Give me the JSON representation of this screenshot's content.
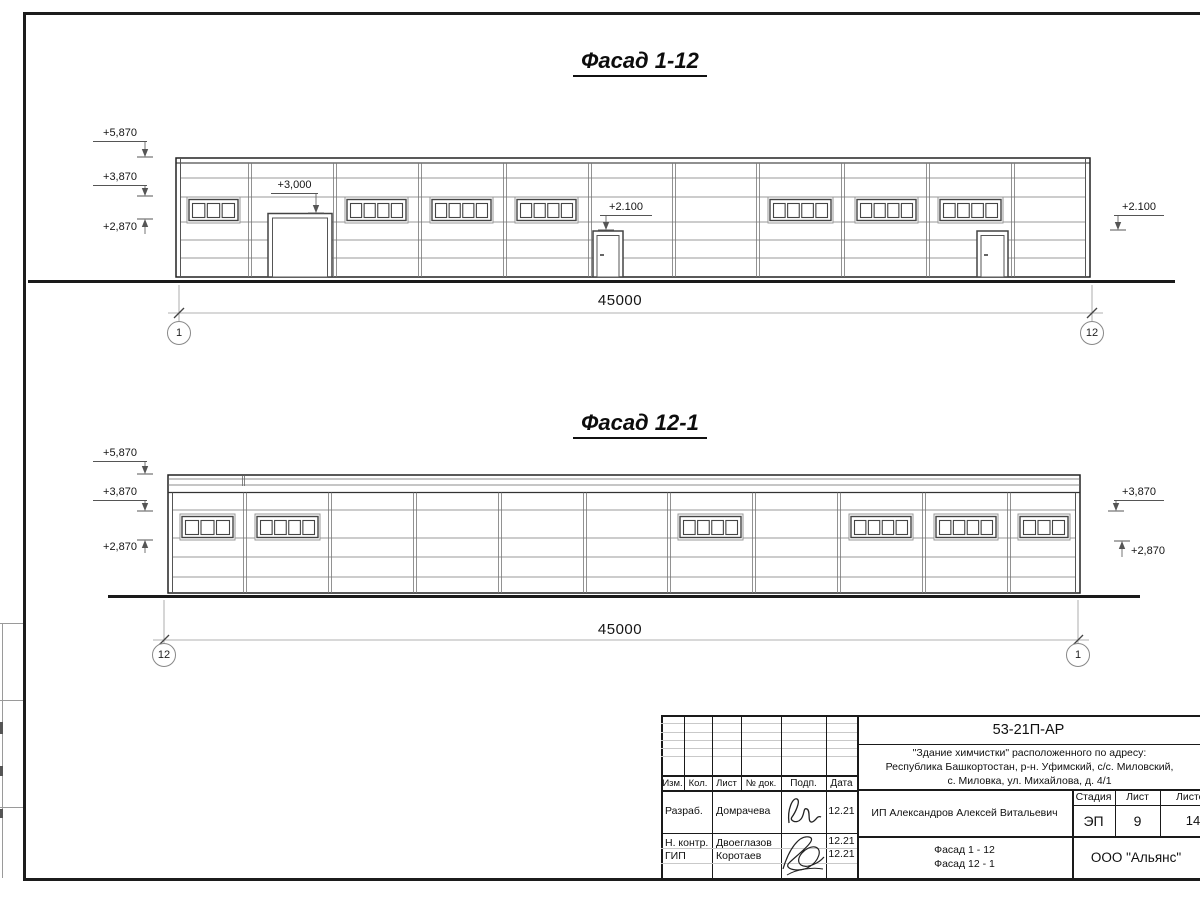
{
  "f1": {
    "title": "Фасад 1-12",
    "dim_total": "45000",
    "axis_left": "1",
    "axis_right": "12",
    "marks": {
      "m5870": "+5,870",
      "m3870": "+3,870",
      "m2870": "+2,870",
      "gate": "+3,000",
      "door": "+2.100",
      "right": "+2.100"
    }
  },
  "f2": {
    "title": "Фасад 12-1",
    "dim_total": "45000",
    "axis_left": "12",
    "axis_right": "1",
    "marks": {
      "m5870": "+5,870",
      "m3870": "+3,870",
      "m2870": "+2,870",
      "right_3870": "+3,870",
      "right_2870": "+2,870"
    }
  },
  "titleblock": {
    "doc_number": "53-21П-АР",
    "project_line1": "\"Здание химчистки\" расположенного по адресу:",
    "project_line2": "Республика Башкортостан, р-н. Уфимский, с/с. Миловский,",
    "project_line3": "с. Миловка, ул. Михайлова, д. 4/1",
    "client": "ИП Александров Алексей Витальевич",
    "sheet_content_line1": "Фасад 1 - 12",
    "sheet_content_line2": "Фасад 12 - 1",
    "company": "ООО \"Альянс\"",
    "stage_label": "Стадия",
    "list_label": "Лист",
    "listov_label": "Листов",
    "stage": "ЭП",
    "list": "9",
    "listov": "14",
    "col_izm": "Изм.",
    "col_kol": "Кол.",
    "col_list": "Лист",
    "col_dok": "№ док.",
    "col_podp": "Подп.",
    "col_data": "Дата",
    "rows": [
      {
        "role": "Разраб.",
        "name": "Домрачева",
        "date": "12.21"
      },
      {
        "role": "Н. контр.",
        "name": "Двоеглазов",
        "date": "12.21"
      },
      {
        "role": "ГИП",
        "name": "Коротаев",
        "date": "12.21"
      }
    ]
  }
}
